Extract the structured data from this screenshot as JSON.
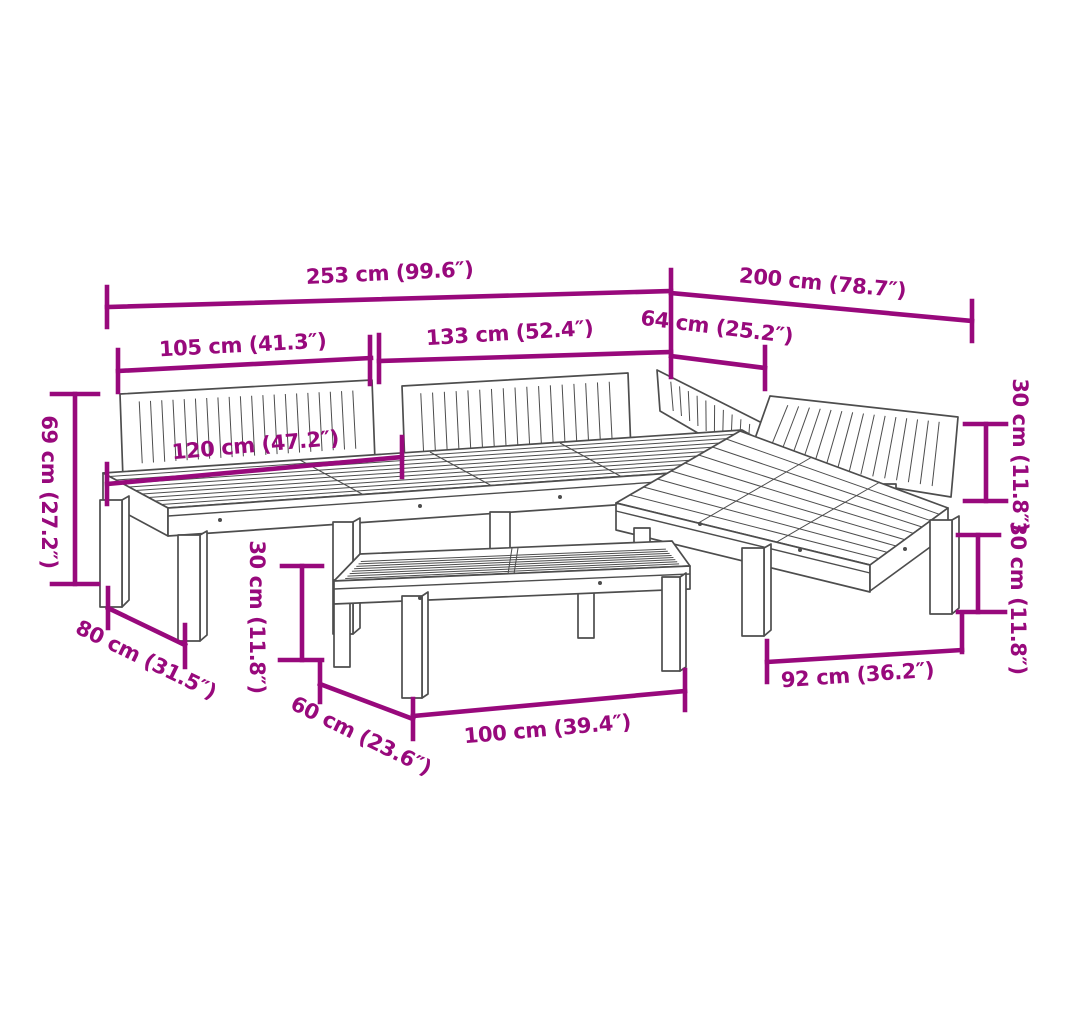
{
  "diagram": {
    "type": "product-dimension-diagram",
    "subject": "pallet garden lounge set with coffee table",
    "unit_note": "centimetres with inches in parentheses",
    "colors": {
      "dimension_accent": "#98097C",
      "artwork_line": "#4D4D4D",
      "background": "#FFFFFF"
    },
    "dimensions": {
      "overall_width": "253 cm (99.6″)",
      "overall_depth": "200 cm (78.7″)",
      "left_section_width": "105 cm (41.3″)",
      "middle_section_width": "133 cm (52.4″)",
      "corner_section_width": "64 cm (25.2″)",
      "total_height": "69 cm (27.2″)",
      "backrest_width": "120 cm (47.2″)",
      "backrest_height": "30 cm (11.8″)",
      "seat_height": "30 cm (11.8″)",
      "table_height": "30 cm (11.8″)",
      "seat_depth": "80 cm (31.5″)",
      "table_depth": "60 cm (23.6″)",
      "table_width": "100 cm (39.4″)",
      "right_section_width": "92 cm (36.2″)"
    }
  }
}
